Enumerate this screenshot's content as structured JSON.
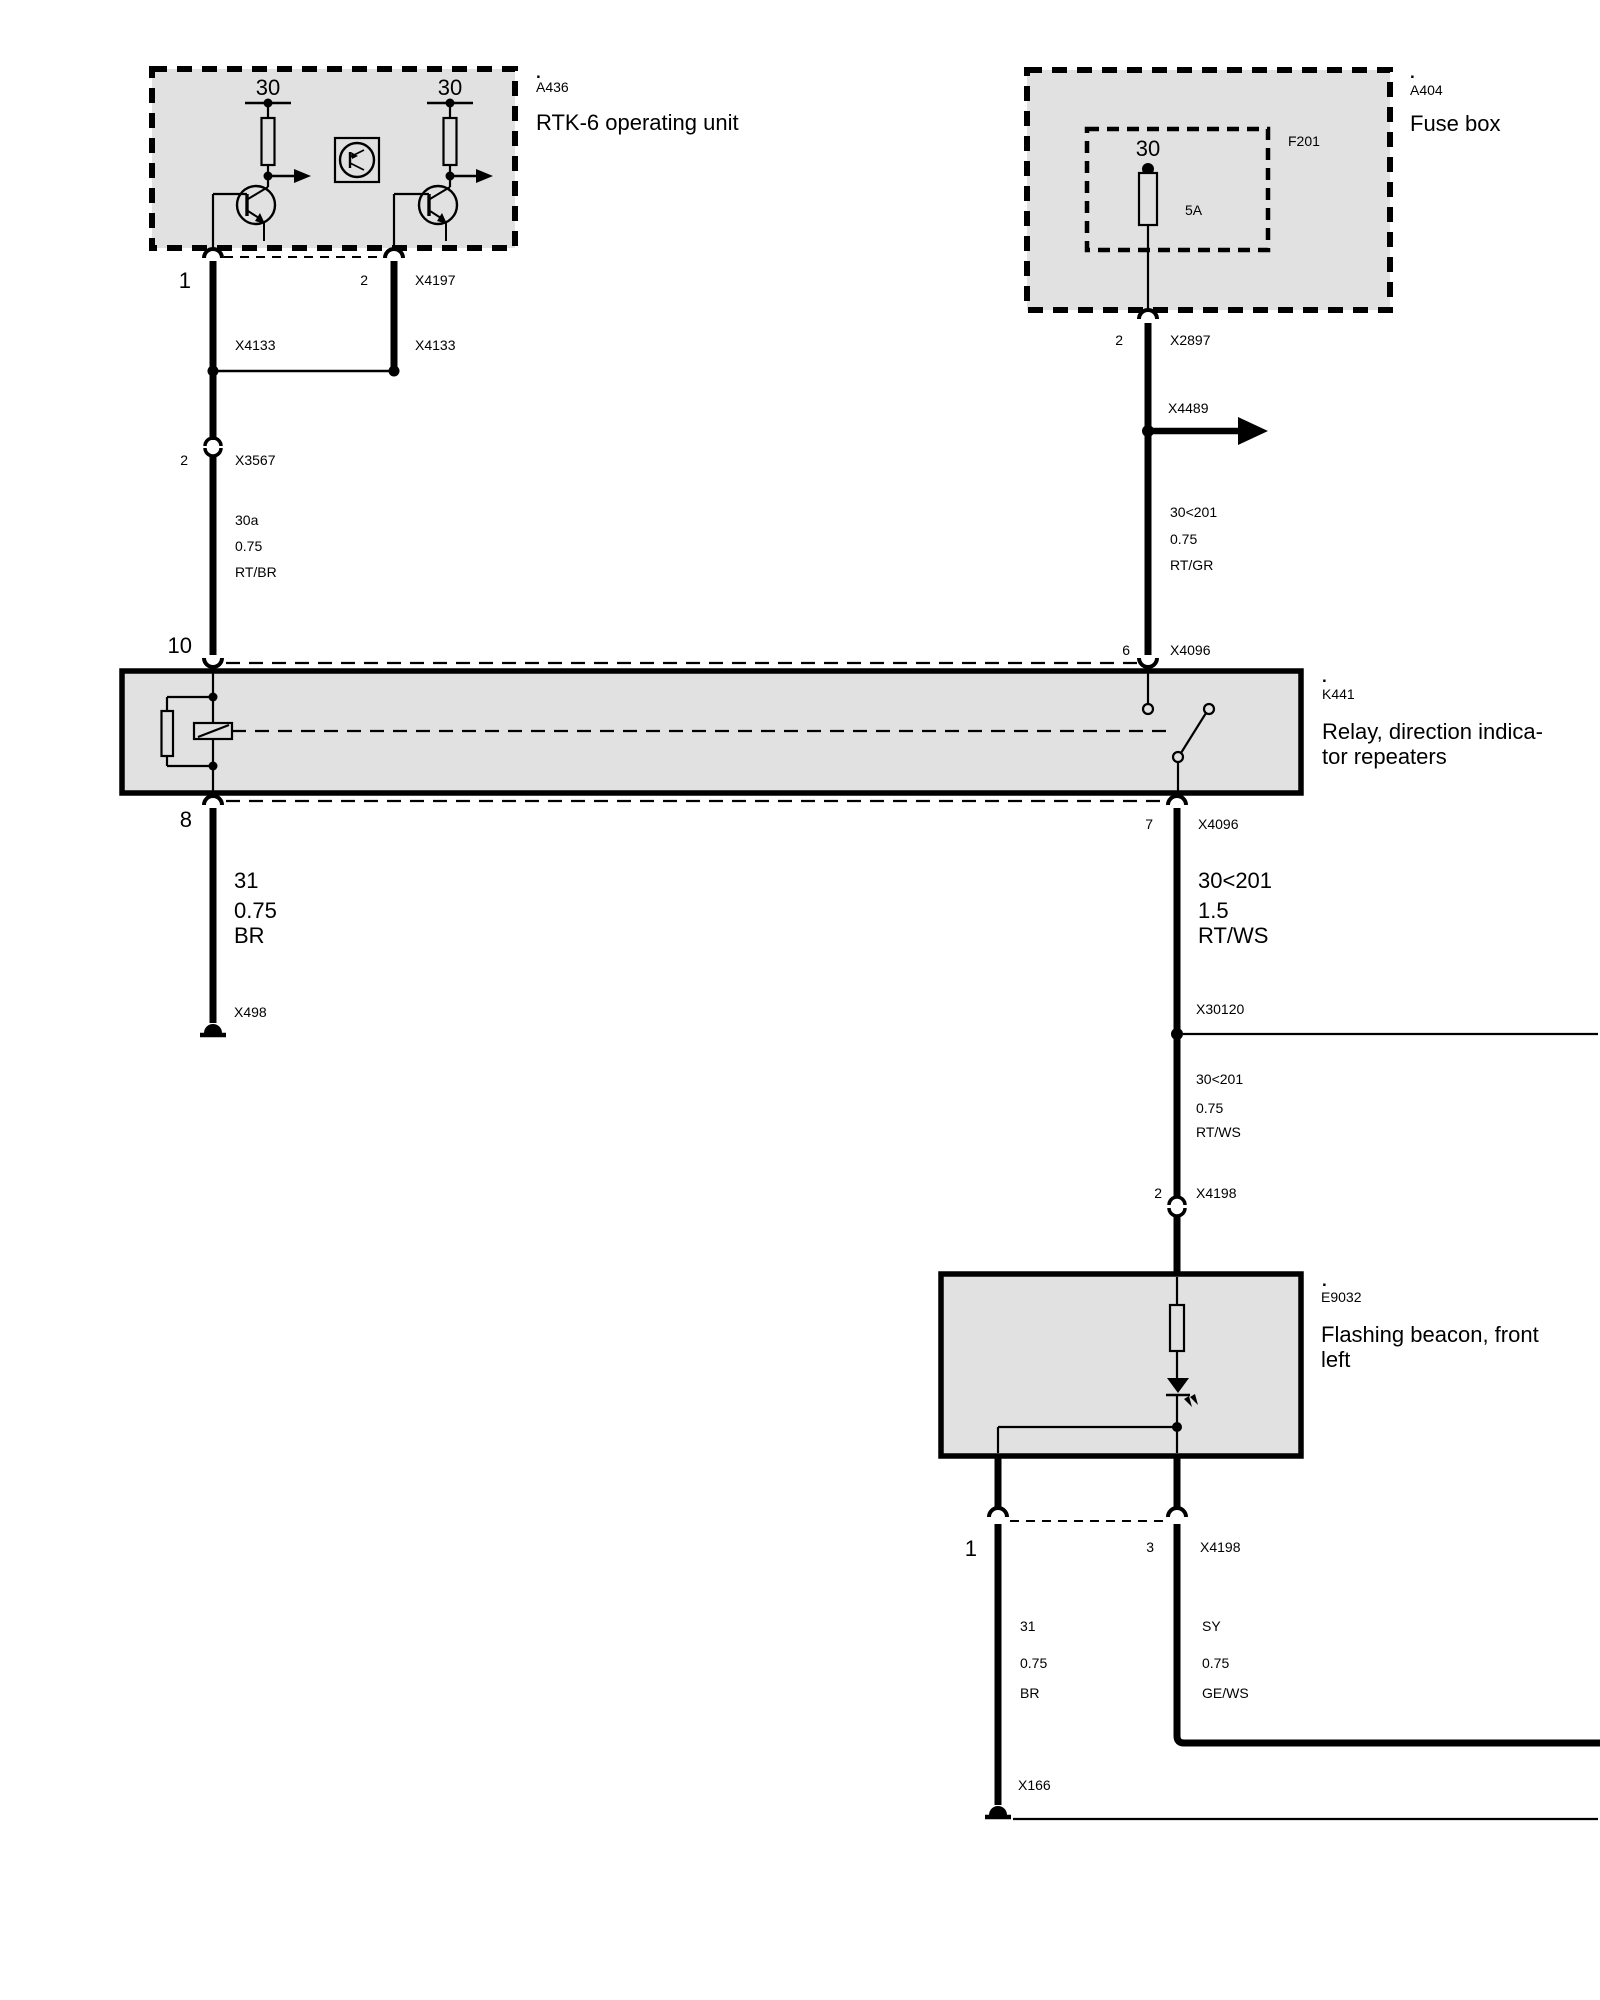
{
  "rtk6": {
    "dot": ".",
    "id": "A436",
    "title": "RTK-6 operating unit",
    "terminal_left": "30",
    "terminal_right": "30",
    "pin_left": "1",
    "pin_right": "2",
    "connector": "X4197",
    "splice_left": "X4133",
    "splice_right": "X4133"
  },
  "fusebox": {
    "dot": ".",
    "id": "A404",
    "title": "Fuse box",
    "carrier_id": "F201",
    "terminal": "30",
    "rating": "5A",
    "pin": "2",
    "connector": "X2897"
  },
  "relay": {
    "dot": ".",
    "id": "K441",
    "title_line1": "Relay, direction indica-",
    "title_line2": "tor repeaters",
    "pin_in_left": "10",
    "pin_out_left": "8",
    "pin_in_right": "6",
    "conn_in_right": "X4096",
    "pin_out_right": "7",
    "conn_out_right": "X4096"
  },
  "beacon": {
    "dot": ".",
    "id": "E9032",
    "title_line1": "Flashing beacon, front",
    "title_line2": "left",
    "pin_left": "1",
    "pin_right": "3",
    "connector": "X4198"
  },
  "left_run": {
    "splice_pin": "2",
    "splice_conn": "X3567",
    "wire_top": {
      "circuit": "30a",
      "gauge": "0.75",
      "color": "RT/BR"
    },
    "wire_bottom": {
      "circuit": "31",
      "gauge": "0.75",
      "color": "BR"
    },
    "ground": "X498"
  },
  "right_run": {
    "branch": "X4489",
    "wire_top": {
      "circuit": "30<201",
      "gauge": "0.75",
      "color": "RT/GR"
    },
    "wire_mid": {
      "circuit": "30<201",
      "gauge": "1.5",
      "color": "RT/WS"
    },
    "junction": "X30120",
    "wire_low": {
      "circuit": "30<201",
      "gauge": "0.75",
      "color": "RT/WS"
    },
    "conn_pin": "2",
    "conn": "X4198"
  },
  "bottom_run": {
    "wire_left": {
      "circuit": "31",
      "gauge": "0.75",
      "color": "BR"
    },
    "wire_right": {
      "circuit": "SY",
      "gauge": "0.75",
      "color": "GE/WS"
    },
    "ground": "X166"
  }
}
